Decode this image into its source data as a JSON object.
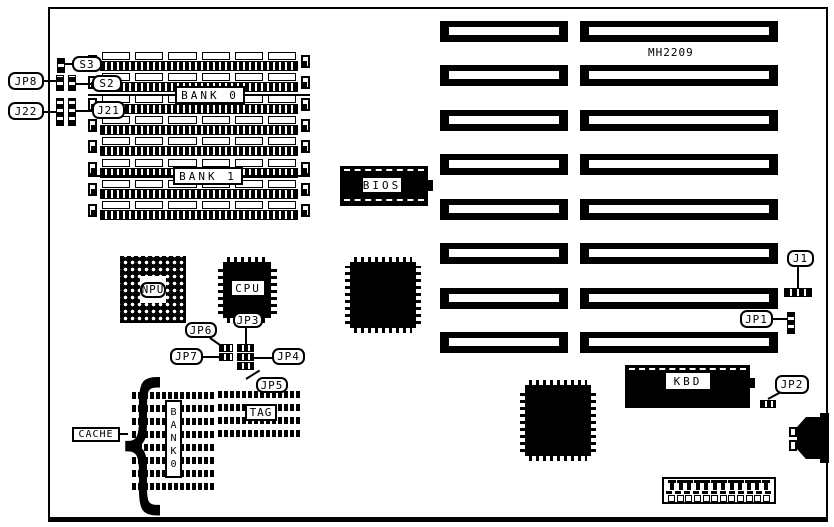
{
  "board": {
    "model_text": "MH2209",
    "brace_glyph": "{"
  },
  "memory": {
    "bank0_label": "BANK 0",
    "bank1_label": "BANK 1",
    "simm_rows": 8,
    "chips_per_row": 6
  },
  "expansion_slots": {
    "rows": 8,
    "columns": 2
  },
  "chips": {
    "bios": "BIOS",
    "npu": "NPU",
    "cpu": "CPU",
    "kbd": "KBD"
  },
  "jumpers": {
    "jp8": "JP8",
    "j22": "J22",
    "s3": "S3",
    "s2": "S2",
    "j21": "J21",
    "jp6": "JP6",
    "jp3": "JP3",
    "jp7": "JP7",
    "jp4": "JP4",
    "jp5": "JP5",
    "j1": "J1",
    "jp1": "JP1",
    "jp2": "JP2"
  },
  "cache": {
    "label": "CACHE",
    "bank_label": "BANK0",
    "tag_label": "TAG"
  },
  "power_connector": {
    "pins": 12
  }
}
